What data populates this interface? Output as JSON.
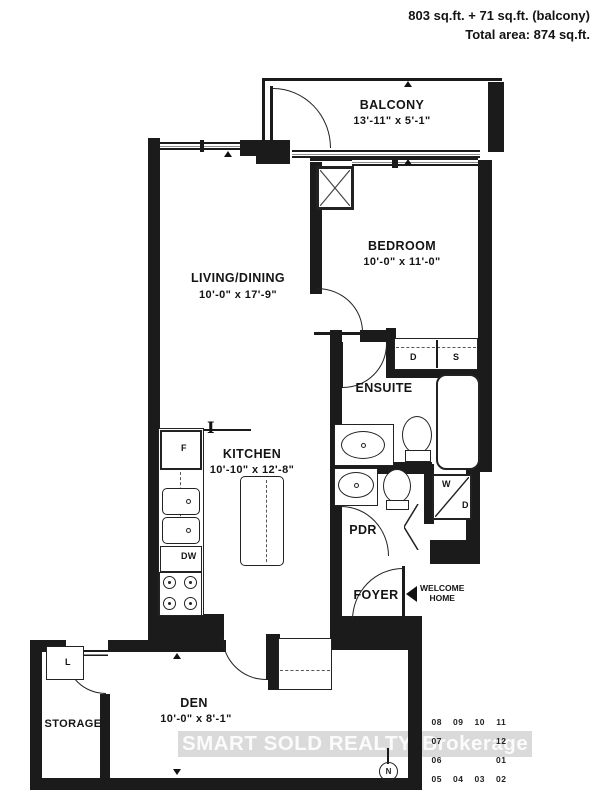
{
  "header": {
    "line1": "803 sq.ft. + 71 sq.ft. (balcony)",
    "line2": "Total area: 874 sq.ft."
  },
  "rooms": {
    "balcony": {
      "name": "BALCONY",
      "dims": "13'-11\" x 5'-1\""
    },
    "bedroom": {
      "name": "BEDROOM",
      "dims": "10'-0\" x 11'-0\""
    },
    "living_dining": {
      "name": "LIVING/DINING",
      "dims": "10'-0\" x 17'-9\""
    },
    "ensuite": {
      "name": "ENSUITE"
    },
    "kitchen": {
      "name": "KITCHEN",
      "dims": "10'-10\" x 12'-8\""
    },
    "pdr": {
      "name": "PDR"
    },
    "foyer": {
      "name": "FOYER"
    },
    "den": {
      "name": "DEN",
      "dims": "10'-0\" x 8'-1\""
    },
    "storage": {
      "name": "STORAGE"
    }
  },
  "fixtures": {
    "fridge": "F",
    "dishwasher": "DW",
    "washer": "W",
    "dryer": "D",
    "closet_d": "D",
    "closet_s": "S",
    "locker": "L",
    "column_marker": "I"
  },
  "entry": {
    "line1": "WELCOME",
    "line2": "HOME"
  },
  "compass": {
    "label": "N"
  },
  "keyplan": {
    "rows": [
      [
        "08",
        "09",
        "10",
        "11"
      ],
      [
        "07",
        "",
        "",
        "12"
      ],
      [
        "06",
        "",
        "",
        "01"
      ],
      [
        "05",
        "04",
        "03",
        "02"
      ]
    ]
  },
  "watermark": "SMART SOLD REALTY, Brokerage",
  "colors": {
    "wall": "#1b1b1b",
    "watermark_bg": "#d2d2d2",
    "watermark_text": "#fbfbfb"
  }
}
